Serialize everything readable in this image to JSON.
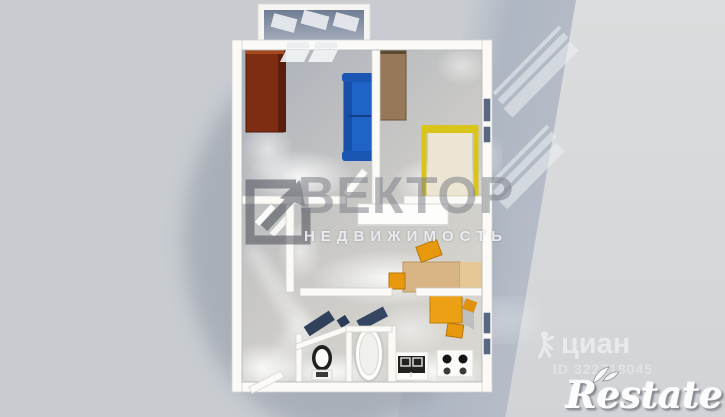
{
  "watermarks": {
    "agency_logo": "square-arrow-icon",
    "agency_title": "ВЕКТОР",
    "agency_subtitle": "НЕДВИЖИМОСТЬ",
    "portal_icon": "walking-person-icon",
    "portal_name": "циан",
    "listing_id": "ID 322718045",
    "corner_brand": "Restate"
  },
  "scene": {
    "type": "3d-top-down-apartment-render",
    "rooms": [
      "balcony",
      "living-room",
      "bedroom",
      "hallway",
      "middle-room",
      "entry-hall",
      "wc",
      "bathroom",
      "kitchen"
    ],
    "objects": [
      "red-wardrobe",
      "blue-sofa",
      "brown-wardrobe",
      "yellow-bed",
      "white-sideboard",
      "desk",
      "stools",
      "kitchen-table",
      "sink-counter",
      "stove",
      "bathtub",
      "toilet",
      "entry-door",
      "windows"
    ]
  },
  "colors": {
    "background": "#c8ccd1",
    "background_band": "#b2b9c4",
    "background_right": "#d8dadc",
    "wall": "#fbfaf7",
    "floor_dark": "#aeb3bc",
    "floor_light": "#d6d4cf",
    "balcony_floor": "#76829a",
    "wardrobe_red": "#7e2c12",
    "sofa_blue": "#1f63c6",
    "wardrobe_brown": "#97785a",
    "bed_frame": "#d9c41a",
    "mattress": "#ece5d3",
    "sideboard": "#fdfdfc",
    "desk": "#d9b586",
    "stool": "#e8980c",
    "table": "#eca014",
    "navy_panel": "#31415c",
    "window_glass": "#5a6780",
    "watermark_gray": "#3f434b"
  }
}
